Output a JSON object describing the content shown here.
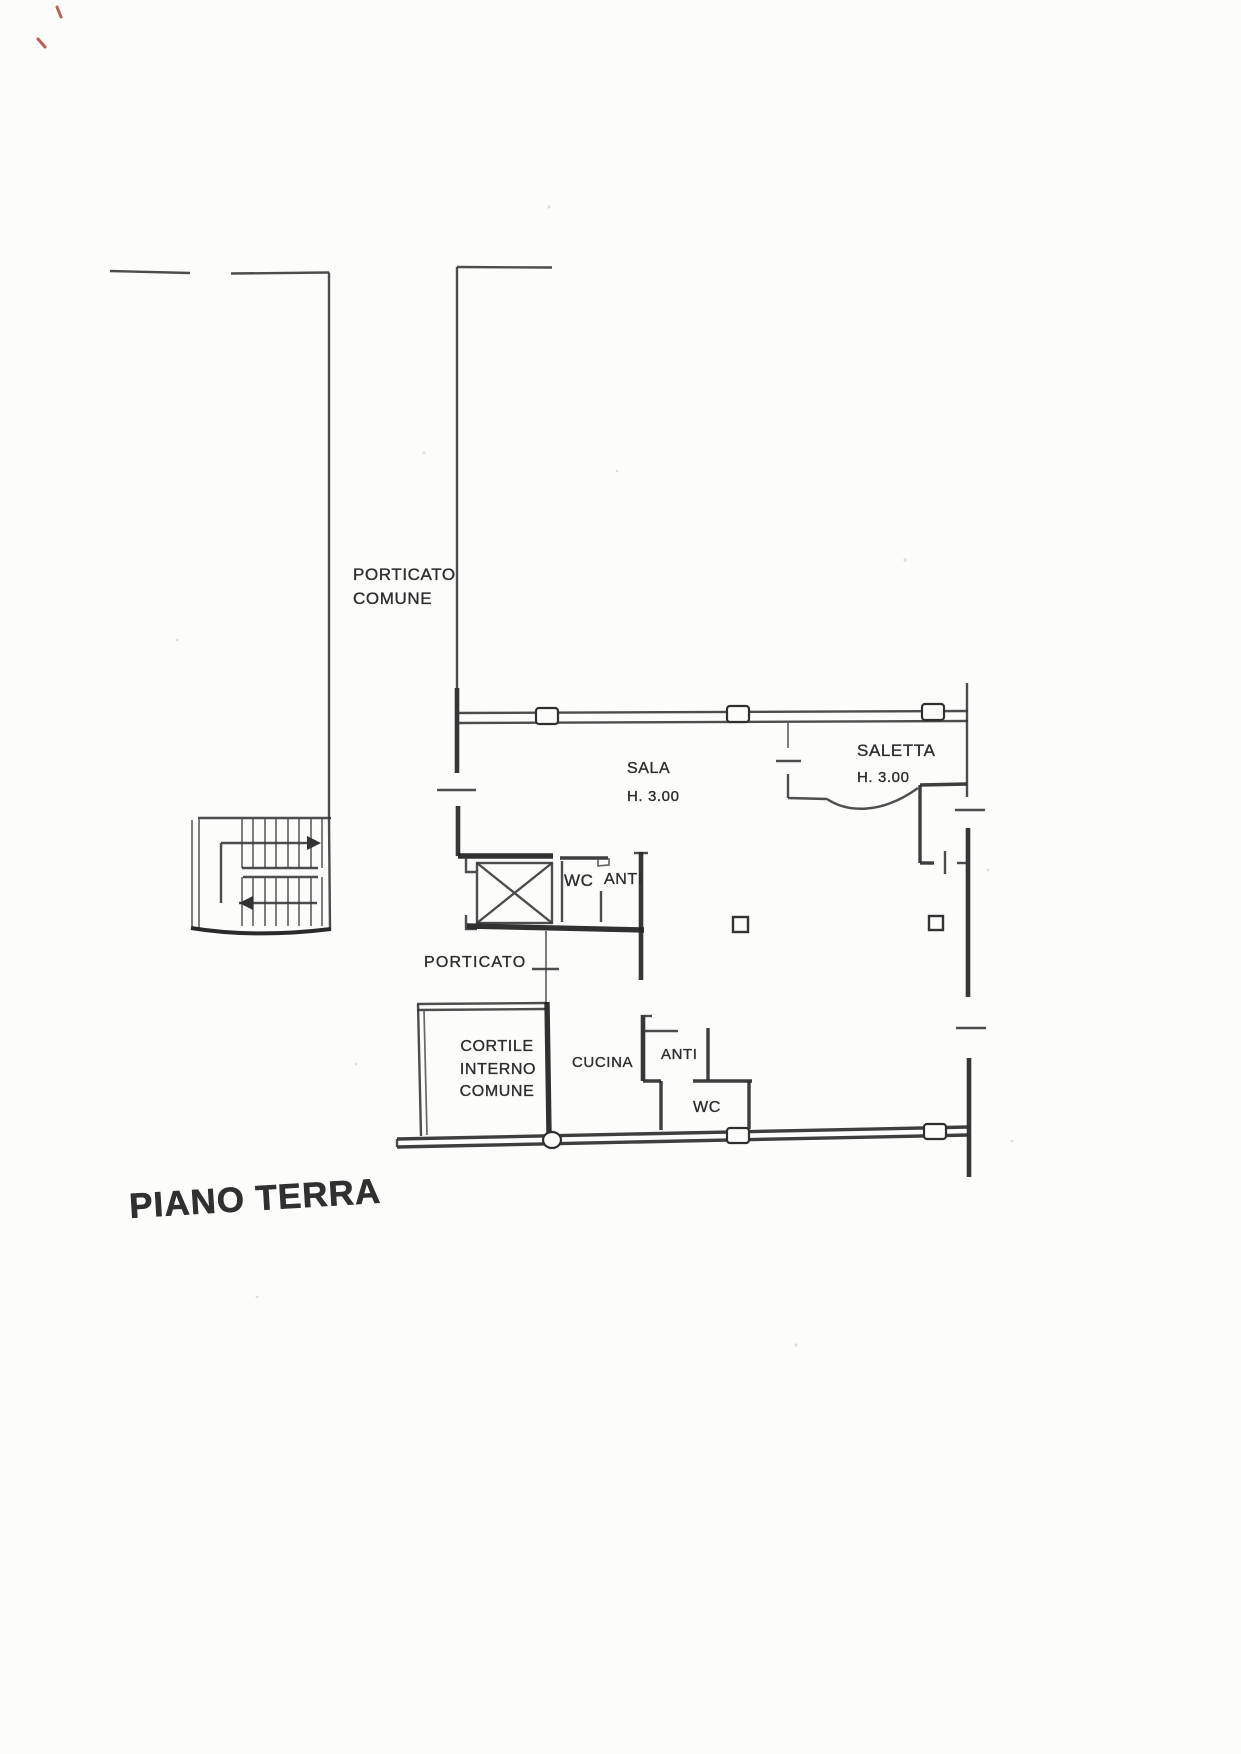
{
  "title": "PIANO TERRA",
  "rooms": {
    "porticato_comune": {
      "line1": "PORTICATO",
      "line2": "COMUNE"
    },
    "sala": {
      "name": "SALA",
      "height": "H. 3.00"
    },
    "saletta": {
      "name": "SALETTA",
      "height": "H. 3.00"
    },
    "wc_upper": "WC",
    "anti_upper": "ANTI",
    "porticato": "PORTICATO",
    "cortile": {
      "line1": "CORTILE",
      "line2": "INTERNO",
      "line3": "COMUNE"
    },
    "cucina": "CUCINA",
    "anti_lower": "ANTI",
    "wc_lower": "WC"
  }
}
